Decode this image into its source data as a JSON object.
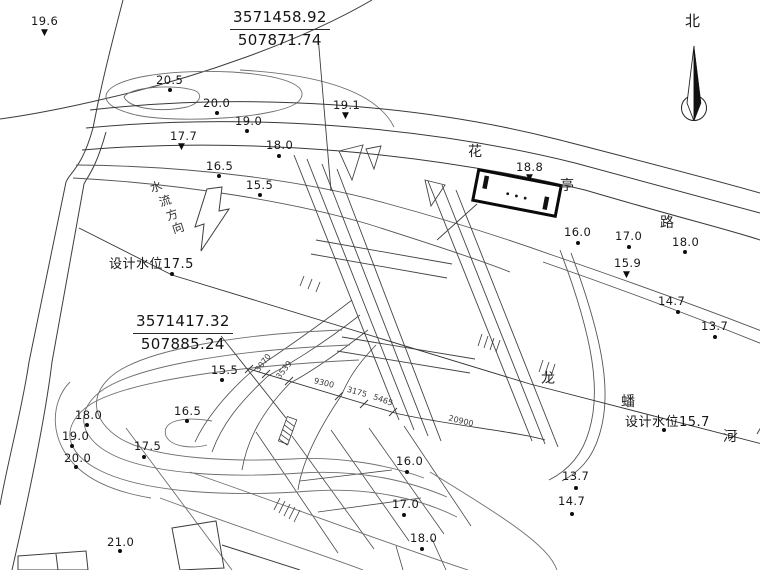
{
  "colors": {
    "background": "#ffffff",
    "line": "#3d3d3d",
    "contour": "#7a7a7a",
    "structure": "#0a0a0a",
    "text": "#1b1b1b"
  },
  "north_arrow": {
    "label": "北"
  },
  "coordinate_labels": [
    {
      "northing": "3571458.92",
      "easting": "507871.74"
    },
    {
      "northing": "3571417.32",
      "easting": "507885.24"
    }
  ],
  "road_name": {
    "full": "花亭路",
    "chars": [
      {
        "ch": "花",
        "x": 468,
        "y": 141
      },
      {
        "ch": "亭",
        "x": 560,
        "y": 175
      },
      {
        "ch": "路",
        "x": 660,
        "y": 212
      }
    ]
  },
  "river_name": {
    "full": "龙蟠河",
    "chars": [
      {
        "ch": "龙",
        "x": 541,
        "y": 368
      },
      {
        "ch": "蟠",
        "x": 621,
        "y": 391
      },
      {
        "ch": "河",
        "x": 723,
        "y": 426
      }
    ]
  },
  "flow_direction": {
    "label": "水流方向",
    "chars": [
      {
        "ch": "水",
        "x": 150,
        "y": 178
      },
      {
        "ch": "流",
        "x": 159,
        "y": 192
      },
      {
        "ch": "方",
        "x": 166,
        "y": 206
      },
      {
        "ch": "向",
        "x": 172,
        "y": 219
      }
    ]
  },
  "design_water_levels": [
    {
      "label": "设计水位17.5",
      "x": 109,
      "y": 253,
      "mx": 172,
      "my": 274
    },
    {
      "label": "设计水位15.7",
      "x": 625,
      "y": 411,
      "mx": 664,
      "my": 430
    }
  ],
  "spot_elevations": [
    {
      "value": "19.6",
      "x": 31,
      "y": 14,
      "marker": "wl",
      "mx": 46,
      "my": 34
    },
    {
      "value": "20.5",
      "x": 156,
      "y": 73,
      "marker": "dot",
      "mx": 170,
      "my": 90
    },
    {
      "value": "20.0",
      "x": 203,
      "y": 96,
      "marker": "dot",
      "mx": 217,
      "my": 113
    },
    {
      "value": "19.0",
      "x": 235,
      "y": 114,
      "marker": "dot",
      "mx": 247,
      "my": 131
    },
    {
      "value": "17.7",
      "x": 170,
      "y": 129,
      "marker": "wl",
      "mx": 183,
      "my": 148
    },
    {
      "value": "18.0",
      "x": 266,
      "y": 138,
      "marker": "dot",
      "mx": 279,
      "my": 156
    },
    {
      "value": "16.5",
      "x": 206,
      "y": 159,
      "marker": "dot",
      "mx": 219,
      "my": 176
    },
    {
      "value": "15.5",
      "x": 246,
      "y": 178,
      "marker": "dot",
      "mx": 260,
      "my": 195
    },
    {
      "value": "19.1",
      "x": 333,
      "y": 98,
      "marker": "wl",
      "mx": 347,
      "my": 117
    },
    {
      "value": "18.8",
      "x": 516,
      "y": 160,
      "marker": "wl",
      "mx": 531,
      "my": 179
    },
    {
      "value": "16.0",
      "x": 564,
      "y": 225,
      "marker": "dot",
      "mx": 578,
      "my": 243
    },
    {
      "value": "17.0",
      "x": 615,
      "y": 229,
      "marker": "dot",
      "mx": 629,
      "my": 247
    },
    {
      "value": "18.0",
      "x": 672,
      "y": 235,
      "marker": "dot",
      "mx": 685,
      "my": 252
    },
    {
      "value": "15.9",
      "x": 614,
      "y": 256,
      "marker": "wl",
      "mx": 628,
      "my": 276
    },
    {
      "value": "14.7",
      "x": 658,
      "y": 294,
      "marker": "dot",
      "mx": 678,
      "my": 312
    },
    {
      "value": "13.7",
      "x": 701,
      "y": 319,
      "marker": "dot",
      "mx": 715,
      "my": 337
    },
    {
      "value": "15.5",
      "x": 211,
      "y": 363,
      "marker": "dot",
      "mx": 222,
      "my": 380
    },
    {
      "value": "16.5",
      "x": 174,
      "y": 404,
      "marker": "dot",
      "mx": 187,
      "my": 421
    },
    {
      "value": "18.0",
      "x": 75,
      "y": 408,
      "marker": "dot",
      "mx": 87,
      "my": 425
    },
    {
      "value": "19.0",
      "x": 62,
      "y": 429,
      "marker": "dot",
      "mx": 72,
      "my": 446
    },
    {
      "value": "20.0",
      "x": 64,
      "y": 451,
      "marker": "dot",
      "mx": 76,
      "my": 467
    },
    {
      "value": "17.5",
      "x": 134,
      "y": 439,
      "marker": "dot",
      "mx": 144,
      "my": 457
    },
    {
      "value": "21.0",
      "x": 107,
      "y": 535,
      "marker": "dot",
      "mx": 120,
      "my": 551
    },
    {
      "value": "16.0",
      "x": 396,
      "y": 454,
      "marker": "dot",
      "mx": 407,
      "my": 472
    },
    {
      "value": "17.0",
      "x": 392,
      "y": 497,
      "marker": "dot",
      "mx": 404,
      "my": 515
    },
    {
      "value": "18.0",
      "x": 410,
      "y": 531,
      "marker": "dot",
      "mx": 422,
      "my": 549
    },
    {
      "value": "13.7",
      "x": 562,
      "y": 469,
      "marker": "dot",
      "mx": 576,
      "my": 488
    },
    {
      "value": "14.7",
      "x": 558,
      "y": 494,
      "marker": "dot",
      "mx": 572,
      "my": 514
    }
  ],
  "dimensions": [
    {
      "value": "3070",
      "x": 263,
      "y": 363,
      "rot": -52
    },
    {
      "value": "3539",
      "x": 284,
      "y": 370,
      "rot": -52
    },
    {
      "value": "9300",
      "x": 324,
      "y": 383,
      "rot": 14
    },
    {
      "value": "3175",
      "x": 357,
      "y": 392,
      "rot": 16
    },
    {
      "value": "5465",
      "x": 383,
      "y": 400,
      "rot": 20
    },
    {
      "value": "20900",
      "x": 461,
      "y": 421,
      "rot": 14
    }
  ]
}
